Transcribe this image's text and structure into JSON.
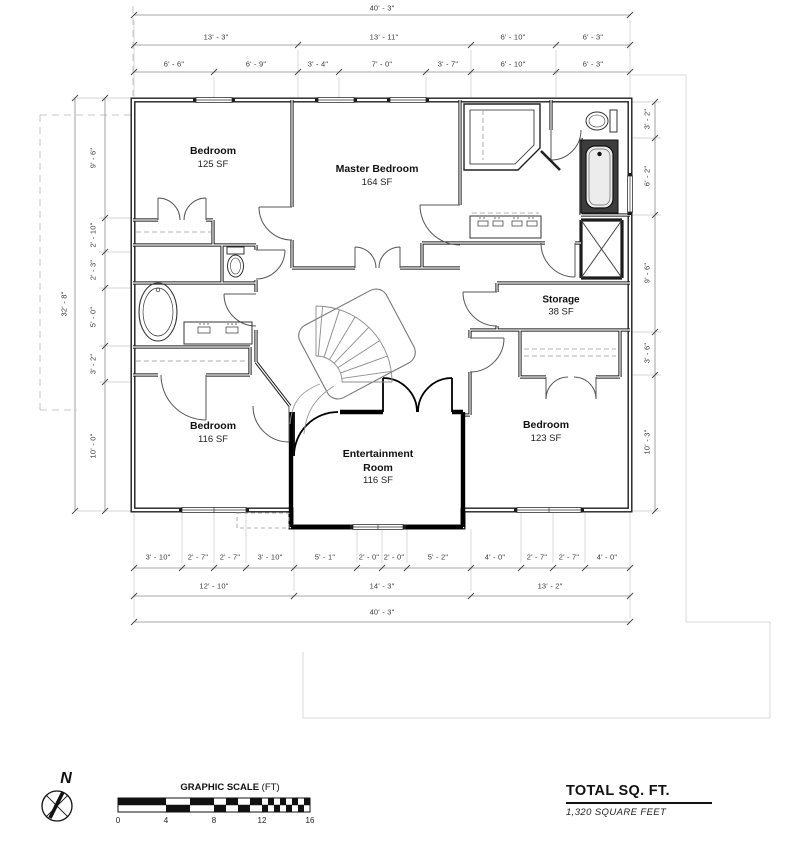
{
  "rooms": [
    {
      "name": "Bedroom",
      "area": "125 SF"
    },
    {
      "name": "Master Bedroom",
      "area": "164 SF"
    },
    {
      "name": "Storage",
      "area": "38 SF"
    },
    {
      "name": "Bedroom",
      "area": "116 SF"
    },
    {
      "name": "Entertainment Room",
      "area": "116 SF"
    },
    {
      "name": "Bedroom",
      "area": "123 SF"
    }
  ],
  "dims": {
    "top_overall": "40' - 3\"",
    "top_mid": [
      "13' - 3\"",
      "13' - 11\"",
      "6' - 10\"",
      "6' - 3\""
    ],
    "top_detail": [
      "6' - 6\"",
      "6' - 9\"",
      "3' - 4\"",
      "7' - 0\"",
      "3' - 7\"",
      "6' - 10\"",
      "6' - 3\""
    ],
    "left_overall": "32' - 8\"",
    "left_chain": [
      "9' - 6\"",
      "2' - 10\"",
      "2' - 3\"",
      "5' - 0\"",
      "3' - 2\"",
      "10' - 0\""
    ],
    "right_chain": [
      "3' - 2\"",
      "6' - 2\"",
      "9' - 6\"",
      "3' - 6\"",
      "10' - 3\""
    ],
    "bottom_detail": [
      "3' - 10\"",
      "2' - 7\"",
      "2' - 7\"",
      "3' - 10\"",
      "5' - 1\"",
      "2' - 0\"",
      "2' - 0\"",
      "5' - 2\"",
      "4' - 0\"",
      "2' - 7\"",
      "2' - 7\"",
      "4' - 0\""
    ],
    "bottom_mid": [
      "12' - 10\"",
      "14' - 3\"",
      "13' - 2\""
    ],
    "bottom_overall": "40' - 3\""
  },
  "footer": {
    "north_label": "N",
    "scale_title": "GRAPHIC SCALE",
    "scale_unit": "(FT)",
    "scale_ticks": [
      "0",
      "4",
      "8",
      "12",
      "16"
    ],
    "total_title": "TOTAL SQ. FT.",
    "total_value": "1,320 SQUARE FEET"
  },
  "colors": {
    "wall": "#1c1c1c",
    "dimline": "#8a8a8a",
    "text": "#3a3a3a"
  }
}
